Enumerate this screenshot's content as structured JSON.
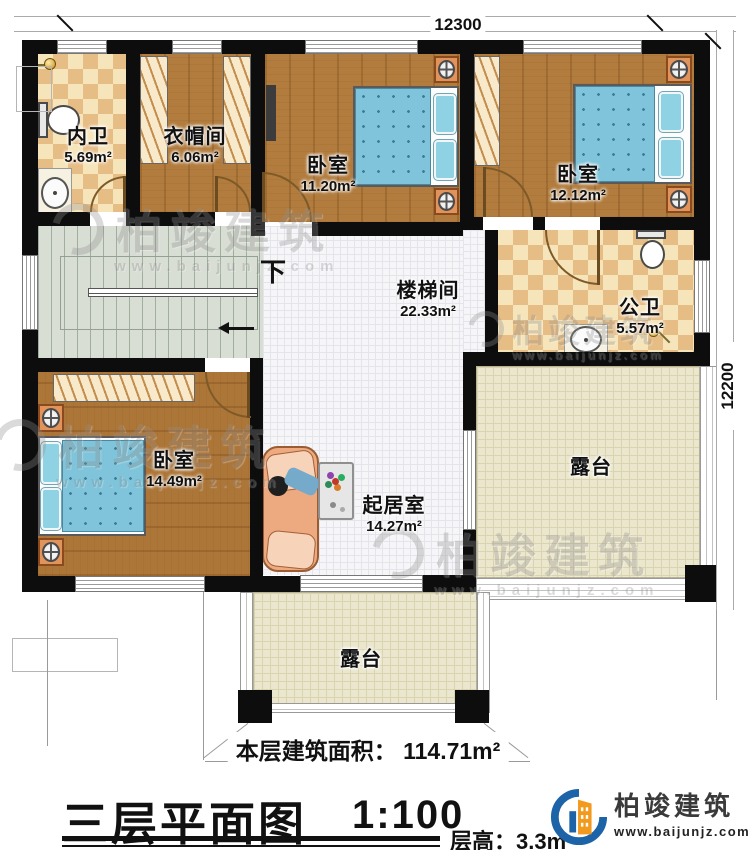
{
  "dimensions": {
    "top": "12300",
    "right": "12200"
  },
  "stairs": {
    "down_label": "下"
  },
  "rooms": {
    "neiwei": {
      "name": "内卫",
      "area": "5.69m²"
    },
    "yimaojian": {
      "name": "衣帽间",
      "area": "6.06m²"
    },
    "bedroom_top_middle": {
      "name": "卧室",
      "area": "11.20m²"
    },
    "bedroom_top_right": {
      "name": "卧室",
      "area": "12.12m²"
    },
    "stairwell": {
      "name": "楼梯间",
      "area": "22.33m²"
    },
    "gongwei": {
      "name": "公卫",
      "area": "5.57m²"
    },
    "bedroom_bottom_left": {
      "name": "卧室",
      "area": "14.49m²"
    },
    "living": {
      "name": "起居室",
      "area": "14.27m²"
    },
    "terrace_right": {
      "name": "露台"
    },
    "terrace_bottom": {
      "name": "露台"
    }
  },
  "title_block": {
    "floor_area_label": "本层建筑面积：",
    "floor_area_value": "114.71m²",
    "title": "三层平面图",
    "scale": "1:100",
    "floor_height_label": "层高：",
    "floor_height_value": "3.3m"
  },
  "logo": {
    "company": "柏竣建筑",
    "website": "www.baijunjz.com"
  },
  "watermark": {
    "text": "柏竣建筑",
    "subtext": "www.baijunjz.com"
  },
  "colors": {
    "wall": "#0d0d0d",
    "wood": "#b27c3e",
    "tile_light": "#f6e5ba",
    "tile_dark": "#e7bd86",
    "terrace": "#ebe7ce",
    "stairs": "#d8ded4",
    "logo_blue": "#1c63a8",
    "logo_orange": "#f29a1e"
  }
}
